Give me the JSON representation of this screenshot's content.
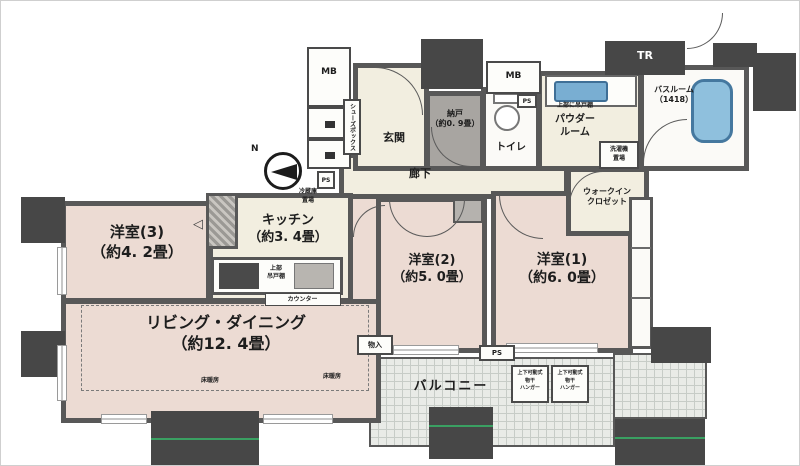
{
  "plan_title": "マンション間取り図",
  "rooms": {
    "yoshitsu3": {
      "name": "洋室(3)",
      "size": "（約4. 2畳）"
    },
    "kitchen": {
      "name": "キッチン",
      "size": "（約3. 4畳）"
    },
    "living": {
      "name": "リビング・ダイニング",
      "size": "（約12. 4畳）"
    },
    "yoshitsu2": {
      "name": "洋室(2)",
      "size": "（約5. 0畳）"
    },
    "yoshitsu1": {
      "name": "洋室(1)",
      "size": "（約6. 0畳）"
    },
    "nando": {
      "name": "納戸",
      "size": "（約0. 9畳）"
    },
    "genkan": {
      "label": "玄関"
    },
    "rouka": {
      "label": "廊下"
    },
    "toilet": {
      "label": "トイレ"
    },
    "powder": {
      "line1": "パウダー",
      "line2": "ルーム"
    },
    "bath": {
      "name": "バスルーム",
      "size": "（1418）"
    },
    "wic": {
      "line1": "ウォークイン",
      "line2": "クロゼット"
    },
    "balcony": {
      "label": "バルコニー"
    }
  },
  "labels": {
    "mb": "MB",
    "tr": "TR",
    "ps": "PS",
    "laundry_line1": "洗濯機",
    "laundry_line2": "置場",
    "fridge_line1": "冷蔵庫",
    "fridge_line2": "置場",
    "counter": "カウンター",
    "kitchen_shelf_line1": "上部",
    "kitchen_shelf_line2": "吊戸棚",
    "powder_shelf": "上部に吊戸棚",
    "floor_heating": "床暖房",
    "mono_ire": "物入",
    "shoes_box": "シューズボックス",
    "compass_n": "N",
    "door_arrow": "◁"
  },
  "hanger_box": {
    "line1": "上下可動式",
    "line2": "物干",
    "line3": "ハンガー"
  },
  "colors": {
    "wall": "#585858",
    "pillar": "#474747",
    "room_pink": "#ecdbd3",
    "room_cream": "#f2eee0",
    "balcony_grid": "#e9ebe7",
    "tub_blue": "#8fc0dd",
    "scan_green": "#3aa062"
  }
}
